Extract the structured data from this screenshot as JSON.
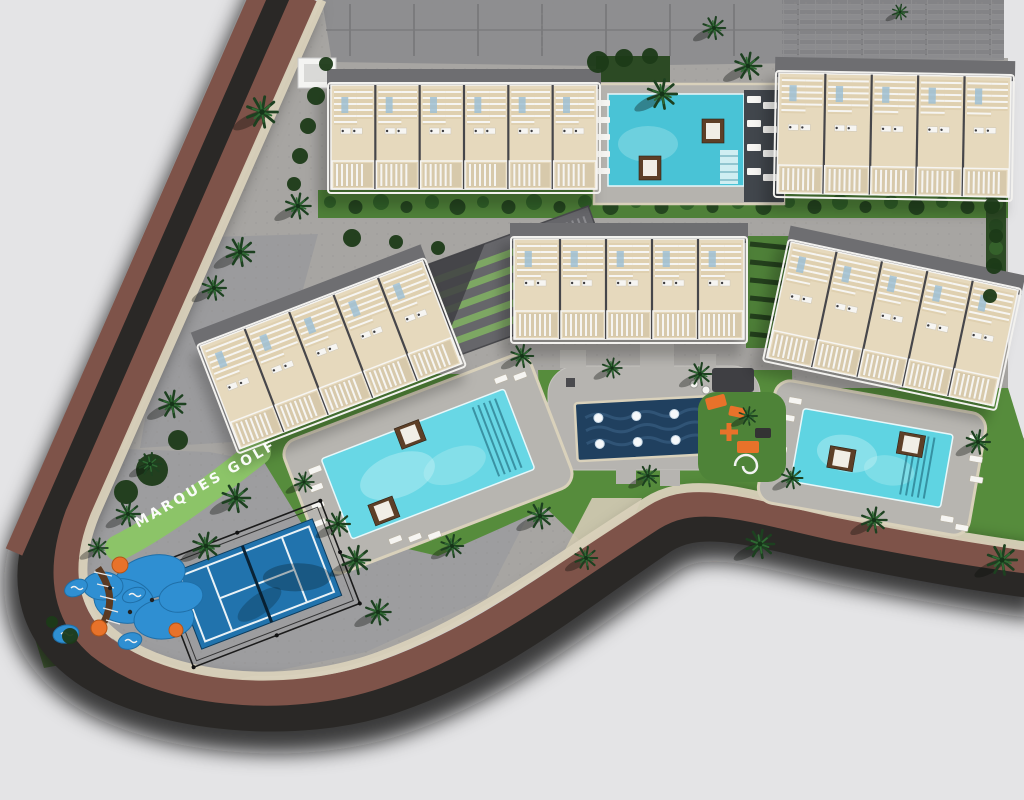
{
  "site_label": {
    "text": "MARQUES GOLF",
    "color": "#ffffff"
  },
  "palette": {
    "background": "#e4e4e6",
    "site_paving": "#a7a5a2",
    "paving_sw": "#9d9d9f",
    "driveway": "#8e8e90",
    "asphalt": "#2a2826",
    "asphalt_dark": "#211f1d",
    "sidewalk_maroon": "#7e5349",
    "curb_cream": "#d9d1bb",
    "lawn": "#568c3c",
    "lawn_bright": "#79b556",
    "hedge_dark": "#24451f",
    "scrub": "#1c3a18",
    "label_strip_green": "#8cc468",
    "pool_deck": "#b7b5b0",
    "dark_deck": "#41464c",
    "water_feature_navy": "#20405f",
    "court_blue": "#2173ad",
    "play_blue": "#2f8fd2",
    "play_orange": "#e8722a",
    "building_beige": "#e6d9bd",
    "building_white": "#f2f1ee",
    "roof_gray": "#6e6e71",
    "cabana_brown": "#5d3f27"
  },
  "buildings": [
    {
      "id": "top-left",
      "cx": 464,
      "cy": 134,
      "w": 266,
      "h": 118,
      "rot": 0,
      "units": 6
    },
    {
      "id": "top-right",
      "cx": 894,
      "cy": 132,
      "w": 232,
      "h": 134,
      "rot": 1,
      "units": 5
    },
    {
      "id": "mid-left",
      "cx": 330,
      "cy": 352,
      "w": 238,
      "h": 124,
      "rot": -21,
      "units": 5
    },
    {
      "id": "mid-center",
      "cx": 629,
      "cy": 286,
      "w": 230,
      "h": 114,
      "rot": 0,
      "units": 5
    },
    {
      "id": "mid-right",
      "cx": 893,
      "cy": 321,
      "w": 232,
      "h": 132,
      "rot": 12,
      "units": 5
    }
  ],
  "pools": [
    {
      "id": "left-pool",
      "cx": 428,
      "cy": 464,
      "rot": -21,
      "w": 196,
      "h": 86,
      "deck_w": 264,
      "deck_h": 142,
      "water": "#68d7e5",
      "steps_x": 62,
      "cabanas": [
        [
          -58,
          28
        ],
        [
          -6,
          -34
        ]
      ],
      "loungers": [
        {
          "x": -114,
          "y": -38,
          "n": 4,
          "dx": -5,
          "dy": 17
        },
        {
          "x": -64,
          "y": 56,
          "n": 3,
          "dx": 19,
          "dy": 5
        },
        {
          "x": 92,
          "y": -56,
          "n": 2,
          "dx": 19,
          "dy": 4
        }
      ]
    },
    {
      "id": "right-pool",
      "cx": 872,
      "cy": 458,
      "rot": 10,
      "w": 152,
      "h": 74,
      "deck_w": 214,
      "deck_h": 124,
      "water": "#5fd4e2",
      "steps_x": 34,
      "cabanas": [
        [
          36,
          -20
        ],
        [
          -30,
          6
        ]
      ],
      "loungers": [
        {
          "x": -92,
          "y": -46,
          "n": 2,
          "dx": -4,
          "dy": 18
        },
        {
          "x": -98,
          "y": 4,
          "n": 2,
          "dx": -4,
          "dy": 18
        },
        {
          "x": 92,
          "y": -40,
          "n": 3,
          "dx": 4,
          "dy": 20
        },
        {
          "x": 78,
          "y": 44,
          "n": 2,
          "dx": 16,
          "dy": 6
        }
      ]
    }
  ],
  "top_pool": {
    "deck": [
      594,
      84,
      190,
      120
    ],
    "water": [
      608,
      94,
      136,
      92
    ],
    "water_color": "#49c3d6",
    "dark_deck": [
      744,
      90,
      40,
      112
    ],
    "hedge": [
      596,
      56,
      74,
      26
    ],
    "cabanas": [
      [
        713,
        131
      ],
      [
        650,
        168
      ]
    ],
    "steps": [
      720,
      150,
      18,
      34
    ],
    "lounger_cols": [
      {
        "x": 597,
        "y": 100,
        "n": 5,
        "dy": 17,
        "w": 13,
        "h": 6
      },
      {
        "x": 747,
        "y": 96,
        "n": 4,
        "dy": 24,
        "w": 14,
        "h": 7
      },
      {
        "x": 763,
        "y": 102,
        "n": 4,
        "dy": 24,
        "w": 14,
        "h": 7
      }
    ]
  },
  "water_feature": {
    "cx": 656,
    "cy": 428,
    "w": 160,
    "h": 58,
    "rot": -3,
    "jet_rows": 2,
    "jet_cols": 4
  },
  "paddle_court": {
    "cx": 257,
    "cy": 584,
    "w": 150,
    "h": 82,
    "rot": -21
  },
  "ramp_structure": {
    "cx": 520,
    "cy": 282,
    "w": 180,
    "h": 96,
    "rot": -20,
    "stripes": 5
  },
  "playground": {
    "surface_blobs": [
      [
        150,
        577,
        36,
        21,
        -15
      ],
      [
        124,
        601,
        30,
        22,
        10
      ],
      [
        164,
        619,
        30,
        20,
        -5
      ],
      [
        103,
        586,
        20,
        14,
        0
      ],
      [
        181,
        597,
        22,
        15,
        -10
      ]
    ],
    "orange_spots": [
      [
        120,
        565,
        8
      ],
      [
        99,
        628,
        8
      ],
      [
        176,
        630,
        7
      ]
    ],
    "island_pads": [
      [
        76,
        588,
        12,
        8,
        -25
      ],
      [
        134,
        595,
        12,
        7,
        -20
      ],
      [
        66,
        634,
        13,
        9,
        -10
      ],
      [
        130,
        641,
        12,
        8,
        -15
      ]
    ],
    "rope_path": "M98,568 C110,586 114,602 104,622"
  },
  "gym": {
    "pad": [
      698,
      392,
      88,
      90
    ],
    "orange_items": [
      [
        716,
        402,
        20,
        12,
        -15
      ],
      [
        737,
        412,
        16,
        10,
        12
      ],
      [
        748,
        447,
        22,
        12,
        0
      ]
    ],
    "cross": [
      729,
      432
    ],
    "mat": [
      755,
      428,
      16,
      10
    ],
    "spiral": [
      746,
      466,
      11
    ],
    "chairs": [
      [
        738,
        443,
        25
      ],
      [
        752,
        455,
        40
      ]
    ],
    "tables": [
      [
        694,
        384
      ],
      [
        706,
        390
      ]
    ],
    "pergola": [
      712,
      368,
      42,
      24
    ]
  },
  "vineyard_rows": {
    "box": [
      746,
      236,
      48,
      112
    ],
    "rows": 6
  },
  "canopy": [
    298,
    58,
    38,
    30
  ],
  "palms": [
    [
      262,
      112,
      1.1
    ],
    [
      298,
      206,
      0.9
    ],
    [
      240,
      252,
      1.0
    ],
    [
      214,
      288,
      0.85
    ],
    [
      172,
      404,
      0.95
    ],
    [
      150,
      464,
      0.8
    ],
    [
      128,
      514,
      0.85
    ],
    [
      236,
      498,
      1.0
    ],
    [
      206,
      546,
      0.95
    ],
    [
      98,
      548,
      0.7
    ],
    [
      356,
      560,
      1.0
    ],
    [
      378,
      612,
      0.9
    ],
    [
      338,
      524,
      0.85
    ],
    [
      304,
      482,
      0.7
    ],
    [
      452,
      546,
      0.8
    ],
    [
      540,
      516,
      0.9
    ],
    [
      586,
      558,
      0.8
    ],
    [
      648,
      476,
      0.75
    ],
    [
      522,
      356,
      0.8
    ],
    [
      612,
      368,
      0.7
    ],
    [
      700,
      374,
      0.8
    ],
    [
      748,
      416,
      0.65
    ],
    [
      662,
      94,
      1.05
    ],
    [
      748,
      66,
      0.95
    ],
    [
      714,
      28,
      0.8
    ],
    [
      900,
      12,
      0.55
    ],
    [
      760,
      544,
      1.0
    ],
    [
      792,
      478,
      0.75
    ],
    [
      874,
      520,
      0.9
    ],
    [
      1002,
      560,
      1.05
    ],
    [
      978,
      442,
      0.85
    ]
  ],
  "scrub_bushes": [
    [
      316,
      96,
      9
    ],
    [
      308,
      126,
      8
    ],
    [
      300,
      156,
      8
    ],
    [
      294,
      184,
      7
    ],
    [
      152,
      470,
      16
    ],
    [
      126,
      492,
      12
    ],
    [
      178,
      440,
      10
    ],
    [
      70,
      636,
      8
    ],
    [
      52,
      622,
      6
    ],
    [
      598,
      62,
      11
    ],
    [
      624,
      58,
      9
    ],
    [
      650,
      56,
      8
    ],
    [
      992,
      206,
      8
    ],
    [
      996,
      236,
      7
    ],
    [
      994,
      266,
      8
    ],
    [
      990,
      296,
      7
    ],
    [
      352,
      238,
      9
    ],
    [
      396,
      242,
      7
    ],
    [
      438,
      248,
      7
    ],
    [
      326,
      64,
      7
    ]
  ]
}
